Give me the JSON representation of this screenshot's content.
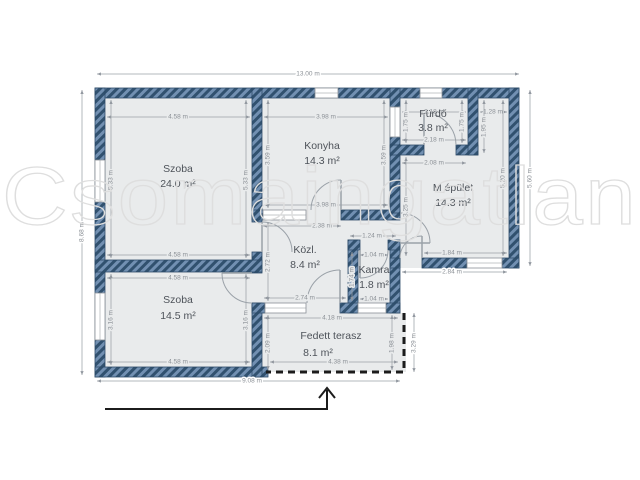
{
  "watermark": "Csomaingatlan",
  "plan": {
    "rooms": {
      "szoba1": {
        "name": "Szoba",
        "area": "24.0 m²"
      },
      "konyha": {
        "name": "Konyha",
        "area": "14.3 m²"
      },
      "furdo": {
        "name": "Fürdő",
        "area": "3.8 m²"
      },
      "mepulet": {
        "name": "M épület",
        "area": "14.3 m²"
      },
      "kozl": {
        "name": "Közl.",
        "area": "8.4 m²"
      },
      "kamra": {
        "name": "Kamra",
        "area": "1.8 m²"
      },
      "szoba2": {
        "name": "Szoba",
        "area": "14.5 m²"
      },
      "terasz": {
        "name": "Fedett terasz",
        "area": "8.1 m²"
      }
    },
    "dims": {
      "total_w": "13.00 m",
      "total_left": "8.68 m",
      "bottom_w": "9.08 m",
      "right_outer": "5.60 m",
      "szoba1": {
        "w": "4.58 m",
        "h": "5.33 m"
      },
      "konyha": {
        "w": "3.98 m",
        "h": "3.59 m"
      },
      "furdo": {
        "w": "2.18 m",
        "h": "1.75 m"
      },
      "niche": {
        "w": "1.28 m",
        "h": "1.95 m"
      },
      "mepulet": {
        "top": "2.08 m",
        "left": "3.25 m",
        "right": "5.20 m",
        "bottom_in": "1.84 m",
        "bottom_out": "2.84 m"
      },
      "kozl": {
        "w": "2.74 m",
        "h": "2.72 m",
        "door": "2.38 m"
      },
      "kamra": {
        "top": "1.24 m",
        "w": "1.04 m",
        "h": "1.74 m"
      },
      "szoba2": {
        "w": "4.58 m",
        "h": "3.16 m"
      },
      "terasz": {
        "top": "4.18 m",
        "bottom": "4.38 m",
        "left": "2.09 m",
        "right": "1.98 m",
        "outer": "3.29 m"
      }
    }
  }
}
